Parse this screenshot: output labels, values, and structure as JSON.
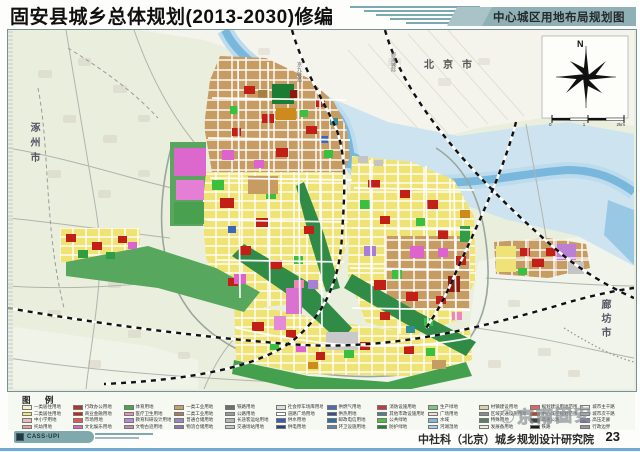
{
  "header": {
    "title": "固安县城乡总体规划(2013-2030)修编",
    "badge": "中心城区用地布局规划图"
  },
  "map": {
    "labels": {
      "north_city": "北京市",
      "west_city": "涿州市",
      "east_city": "廊坊市",
      "railway1": "京九铁路",
      "railway2": "廊涿城际"
    },
    "compass": {
      "north": "N",
      "ticks": [
        "0",
        "1",
        "2km"
      ]
    },
    "palette": {
      "countryside": "#e9efdc",
      "north_plain": "#f4f3ec",
      "floodplain": "#cde4f0",
      "river": "#79b7dc",
      "residential_yellow": "#efe374",
      "industrial_tan": "#c69c63",
      "commercial_red": "#c22017",
      "park_green": "#3bbf3e",
      "protective_green": "#2f8b45",
      "culture_magenta": "#df63cf",
      "accent_teal": "#7ba9af"
    }
  },
  "legend": {
    "title": "图 例",
    "items": [
      {
        "color": "#f7f2c6",
        "label": "一类居住用地"
      },
      {
        "color": "#f3e76e",
        "label": "二类居住用地"
      },
      {
        "color": "#f2b9b9",
        "label": "中小学用地"
      },
      {
        "color": "#e8a0a0",
        "label": "托幼用地"
      },
      {
        "color": "#b5342a",
        "label": "行政办公用地"
      },
      {
        "color": "#d01f1a",
        "label": "商业金融用地"
      },
      {
        "color": "#e2574e",
        "label": "市场用地"
      },
      {
        "color": "#d966c9",
        "label": "文化娱乐用地"
      },
      {
        "color": "#41ab44",
        "label": "体育用地"
      },
      {
        "color": "#ef8fb4",
        "label": "医疗卫生用地"
      },
      {
        "color": "#b78ad6",
        "label": "教育科研设计用地"
      },
      {
        "color": "#c58ab0",
        "label": "文物古迹用地"
      },
      {
        "color": "#c9a168",
        "label": "一类工业用地"
      },
      {
        "color": "#ab7f4a",
        "label": "二类工业用地"
      },
      {
        "color": "#9e85c0",
        "label": "普通仓储用地"
      },
      {
        "color": "#8f76b5",
        "label": "物流仓储用地"
      },
      {
        "color": "#6e6e6e",
        "label": "铁路用地"
      },
      {
        "color": "#9c9c9c",
        "label": "公路用地"
      },
      {
        "color": "#b5b5b5",
        "label": "长途客运站用地"
      },
      {
        "color": "#c8c8c8",
        "label": "交通场站用地"
      },
      {
        "color": "#dcdcdc",
        "label": "社会停车场库用地"
      },
      {
        "color": "#ffffff",
        "label": "道路广场用地"
      },
      {
        "color": "#3b5bb5",
        "label": "供水用地"
      },
      {
        "color": "#27407f",
        "label": "供电用地"
      },
      {
        "color": "#4a6fae",
        "label": "供燃气用地"
      },
      {
        "color": "#33508f",
        "label": "供热用地"
      },
      {
        "color": "#2e6f9e",
        "label": "邮政电信用地"
      },
      {
        "color": "#5b86a6",
        "label": "环卫设施用地"
      },
      {
        "color": "#c23a3a",
        "label": "消防设施用地"
      },
      {
        "color": "#4e7f8c",
        "label": "其他市政设施用地"
      },
      {
        "color": "#49c23f",
        "label": "公共绿地"
      },
      {
        "color": "#1f7f38",
        "label": "防护绿地"
      },
      {
        "color": "#7fc77a",
        "label": "生产绿地"
      },
      {
        "color": "#e8e3d2",
        "label": "广场用地"
      },
      {
        "color": "#7fb9dd",
        "label": "水域"
      },
      {
        "color": "#a9d2e8",
        "label": "河湖湿地"
      },
      {
        "color": "#d9cfa8",
        "label": "村镇建设用地"
      },
      {
        "color": "#8a8a8a",
        "label": "区域交通设施用地"
      },
      {
        "color": "#5e7d62",
        "label": "特殊用地"
      },
      {
        "color": "#efe9d8",
        "label": "发展备用地"
      },
      {
        "color": "#e06666",
        "label": "规划建设用地范围"
      },
      {
        "color": "#cc4125",
        "label": "中心城区规划范围"
      },
      {
        "color": "#444444",
        "label": "高速公路"
      },
      {
        "color": "#1a1a1a",
        "label": "铁路"
      },
      {
        "color": "#f5f5f5",
        "label": "城市主干路"
      },
      {
        "color": "#d9d9d9",
        "label": "城市次干路"
      },
      {
        "color": "#7c6fb0",
        "label": "高压走廊"
      },
      {
        "color": "#999999",
        "label": "行政边界"
      }
    ]
  },
  "footer": {
    "logo_text": "CASS-UPI",
    "institute": "中社科（北京）城乡规划设计研究院",
    "page": "23",
    "watermark": "京南固安"
  }
}
